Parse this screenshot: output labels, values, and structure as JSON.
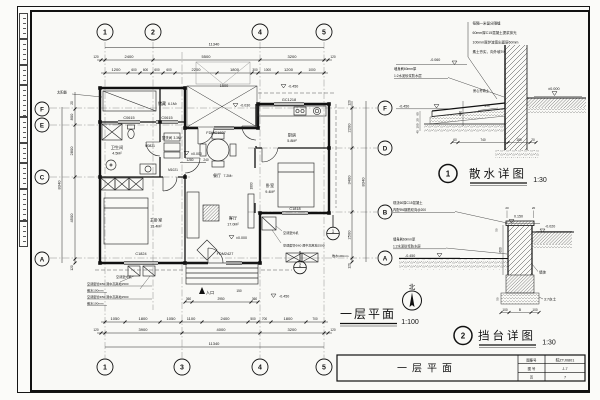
{
  "plan": {
    "title": "一层平面",
    "scale": "1:100",
    "north": "北",
    "solar": "太阳能",
    "grid": {
      "t1": "1",
      "t2": "2",
      "t4": "4",
      "t5": "5",
      "b1": "1",
      "b3": "3",
      "b4": "4",
      "b5": "5",
      "lF": "F",
      "lE": "E",
      "lC": "C",
      "lA": "A",
      "rF": "F",
      "rD": "D",
      "rB": "B",
      "rA": "A"
    },
    "dims": {
      "total": "11340",
      "overall_side": "8340",
      "top2": [
        "120",
        "2400",
        "5500",
        "3200",
        "120"
      ],
      "top3": [
        "1200",
        "600",
        "600",
        "600",
        "600",
        "2200",
        "1800",
        "300",
        "1000",
        "1200",
        "1000"
      ],
      "bot1": [
        "1050",
        "1800",
        "1050",
        "1100",
        "2400",
        "500",
        "700",
        "1800",
        "700"
      ],
      "bot2": [
        "120",
        "3900",
        "4000",
        "3200",
        "120"
      ],
      "left": [
        "20",
        "800",
        "2800",
        "4500",
        "120"
      ],
      "right": [
        "120",
        "2200",
        "3400",
        "2500",
        "120"
      ],
      "steps": [
        "360",
        "2950",
        "360"
      ],
      "d1500": "1500",
      "d1280": "1280",
      "d240": "240",
      "d1800": "1800",
      "d150": "150"
    },
    "levels": {
      "zero": "±0.000",
      "neg030": "-0.030",
      "neg450": "-0.450"
    },
    "rooms": {
      "storage": {
        "name": "储藏",
        "area": "6.1M²"
      },
      "bath": {
        "name": "卫生间",
        "area": "4.5M²"
      },
      "wash": {
        "name": "盥洗间",
        "area": "3.3M²"
      },
      "kitchen": {
        "name": "厨房",
        "area": "5.8M²"
      },
      "dining": {
        "name": "餐厅",
        "area": "7.2M²"
      },
      "living": {
        "name": "客厅",
        "area": "17.0M²"
      },
      "master": {
        "name": "主卧室",
        "area": "15.4M²"
      },
      "bedroom": {
        "name": "卧室",
        "area": "9.4M²"
      }
    },
    "openings": {
      "c0615": "C0615",
      "gc1218": "GC1218",
      "fdmc1827": "FDMC1827",
      "c1818": "C1818",
      "c1824": "C1824",
      "fdm2427": "FDM2427",
      "m0821": "M0821",
      "m1021": "M1021"
    },
    "notes": {
      "entry": "入口",
      "ac_unit": "空调室外机",
      "ac50": "空调套管Φ50 洞中高离地2500",
      "ac60": "空调套管Φ60 洞中高离地2500",
      "apron": "散水100mm"
    },
    "callouts": {
      "c1": "1",
      "c2": "2"
    }
  },
  "detail1": {
    "num": "1",
    "title": "散水详图",
    "scale": "1:30",
    "leaders": [
      "每隔一米留分隔缝",
      "60mm厚C15混凝土提浆抹光",
      "100mm厚炉渣宽出面层60mm",
      "素土夯实，向外坡3%"
    ],
    "wall_note1": "墙身刷60mm厚",
    "wall_note2": "1:2水泥砂浆防水层",
    "mid_note": "房心夯填土",
    "lv_top": "-0.060",
    "lv_zero": "±0.000",
    "lv_low": "-0.450",
    "slope": "3%",
    "dim400": "400",
    "dims_bottom": [
      "60",
      "740",
      "180",
      "20"
    ],
    "dims_left": [
      "60",
      "20",
      "100",
      "40"
    ]
  },
  "detail2": {
    "num": "2",
    "title": "挡台详图",
    "scale": "1:30",
    "note1a": "现浇60厚C15混凝土",
    "note1b": "内配Φ6钢筋双向@200",
    "wall_note1": "墙身刷60mm厚",
    "wall_note2": "1:2水泥砂浆防水层",
    "lv_top": "0.150",
    "lv_right": "-0.020",
    "lv_low": "-0.450",
    "dim600": "600",
    "dim50a": "50",
    "dim50b": "50",
    "dim20a": "20",
    "dim20b": "20",
    "soil": "3:7灰土",
    "wall_label": "墙体",
    "dims_bottom": [
      "100",
      "B",
      "100"
    ]
  },
  "titleblock": {
    "name": "一层平面",
    "row1_label": "图集号",
    "row1_value": "皖ZTJ0801",
    "row2_label": "图 号",
    "row2_value": "J-7",
    "row3_label": "页",
    "row3_value": "7"
  }
}
